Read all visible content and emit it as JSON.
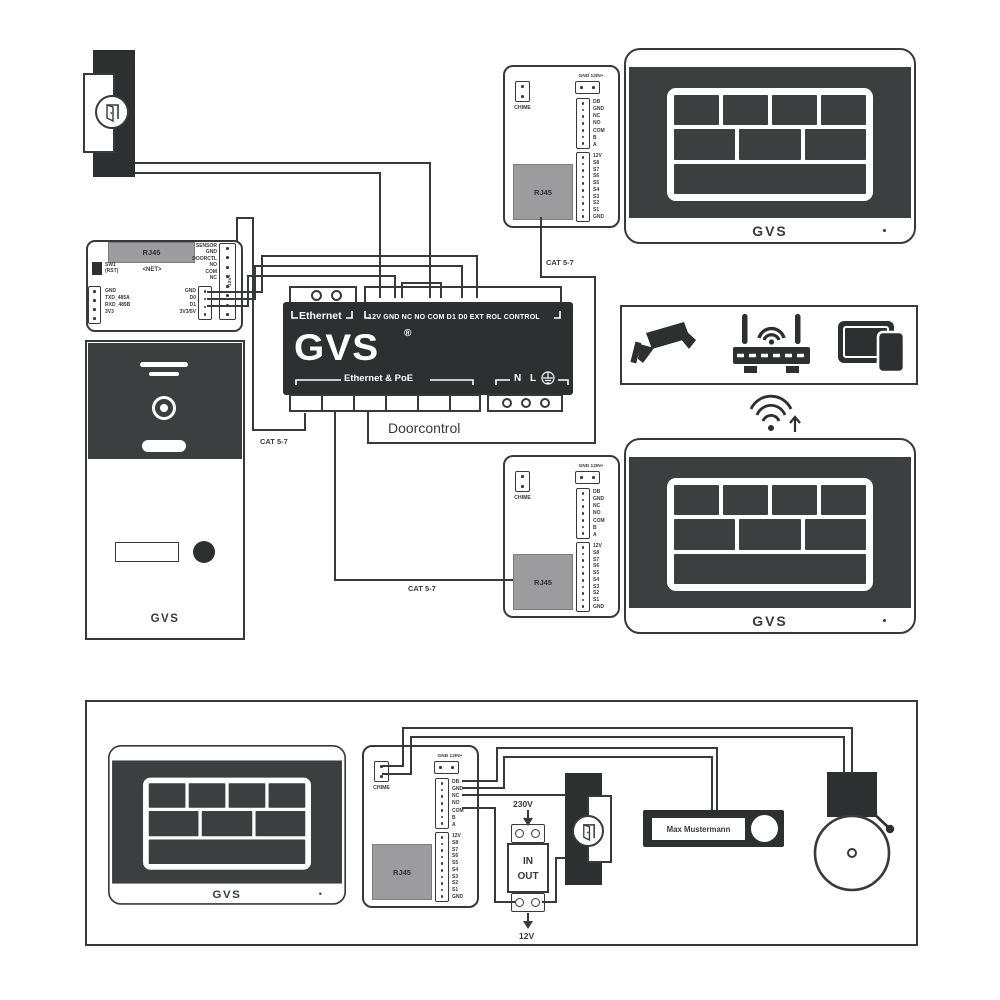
{
  "brand": {
    "logo": "GVS",
    "registered": "®"
  },
  "doorcontrol": {
    "name": "Doorcontrol",
    "ethernet_label": "Ethernet",
    "terminal_row": "12V GND NC NO COM D1 D0 EXT ROL CONTROL",
    "poe_label": "Ethernet & PoE",
    "mains_n": "N",
    "mains_l": "L"
  },
  "cables": {
    "cat_a": "CAT 5-7",
    "cat_b": "CAT 5-7",
    "cat_c": "CAT 5-7"
  },
  "net_module": {
    "rj45_label": "RJ45",
    "net_label": "<NET>",
    "switch_line1": "SW1",
    "switch_line2": "(RST)",
    "serial_pins": [
      "GND",
      "TXD_485A",
      "RXD_485B",
      "3V3"
    ],
    "io_pins": [
      "SENSOR",
      "GND",
      "DOORCTL",
      "NO",
      "COM",
      "NC"
    ],
    "bus_pins": [
      "GND",
      "D0",
      "D1",
      "3V3/5V"
    ],
    "power_label": "-12V+"
  },
  "indoor_station": {
    "chime_label": "CHIME",
    "power_label": "GND 12IN+",
    "bus_pins": [
      "DB",
      "GND",
      "NC",
      "NO",
      "COM",
      "B",
      "A"
    ],
    "scene_pins": [
      "12V",
      "S8",
      "S7",
      "S6",
      "S5",
      "S4",
      "S3",
      "S2",
      "S1",
      "GND"
    ],
    "rj45_label": "RJ45"
  },
  "door_station": {
    "logo": "GVS"
  },
  "monitor": {
    "logo": "GVS"
  },
  "accessories": {
    "mains_voltage": "230V",
    "psu_in": "IN",
    "psu_out": "OUT",
    "output_voltage": "12V",
    "doorbell_name": "Max Mustermann"
  },
  "icons": {
    "camera": "cctv-camera",
    "router": "wifi-router",
    "mobile": "tablet-and-phone",
    "wifi": "wifi-signal-up",
    "earth": "earth-ground",
    "door": "open-door"
  }
}
